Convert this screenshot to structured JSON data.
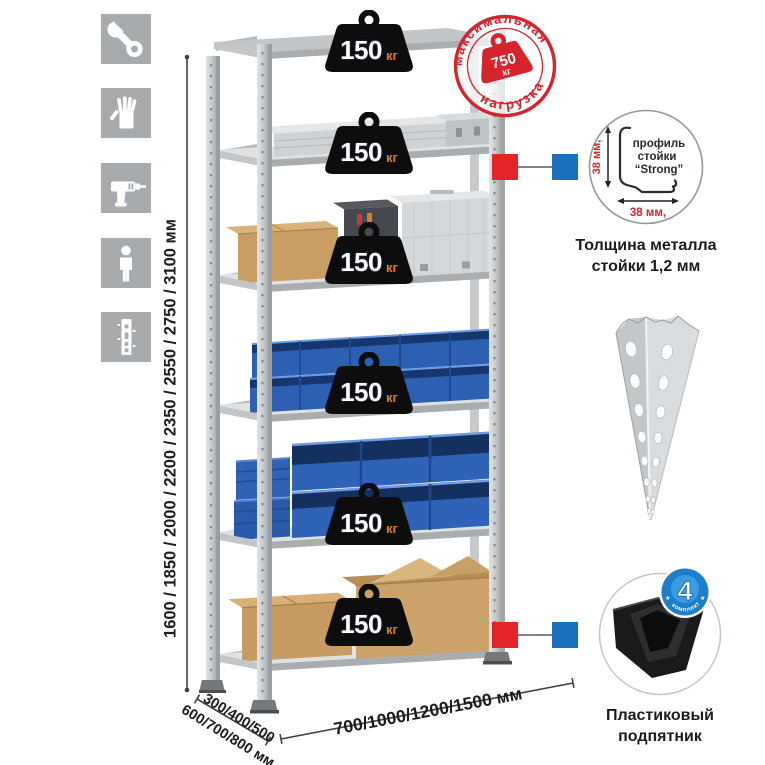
{
  "page": {
    "background": "#ffffff"
  },
  "tool_icons": {
    "tile_color": "#a8abae",
    "items": [
      {
        "name": "wrench"
      },
      {
        "name": "gloves"
      },
      {
        "name": "drill"
      },
      {
        "name": "person"
      },
      {
        "name": "shelf-upright"
      }
    ]
  },
  "dimension_labels": {
    "height": "1600 / 1850 / 2000 / 2200 / 2350 / 2550 / 2750 / 3100 мм",
    "depth_line1": "300/400/500",
    "depth_line2": "600/700/800 мм",
    "width": "700/1000/1200/1500 мм"
  },
  "shelf_badges": [
    {
      "value": "150",
      "unit": "кг"
    },
    {
      "value": "150",
      "unit": "кг"
    },
    {
      "value": "150",
      "unit": "кг"
    },
    {
      "value": "150",
      "unit": "кг"
    },
    {
      "value": "150",
      "unit": "кг"
    },
    {
      "value": "150",
      "unit": "кг"
    }
  ],
  "max_load_stamp": {
    "arc_top": "максимальная",
    "arc_bottom": "нагрузка",
    "value": "750",
    "unit": "кг"
  },
  "profile_detail": {
    "label_line1": "профиль",
    "label_line2": "стойки",
    "label_line3": "“Strong”",
    "height_dim": "38 мм,",
    "width_dim": "38 мм,",
    "caption": "Толщина металла стойки 1,2 мм"
  },
  "foot_detail": {
    "kit_count": "4",
    "kit_label": "в комплекте",
    "star": "★",
    "caption": "Пластиковый подпятник"
  },
  "colors": {
    "accent_red": "#d5242c",
    "connector_blue": "#1a6fbe",
    "bin_blue": "#2e63b7",
    "cardboard": "#c89e65",
    "metal_gray": "#cdd0d3",
    "badge_black": "#0d0d0d",
    "unit_orange": "#e07a1e"
  }
}
